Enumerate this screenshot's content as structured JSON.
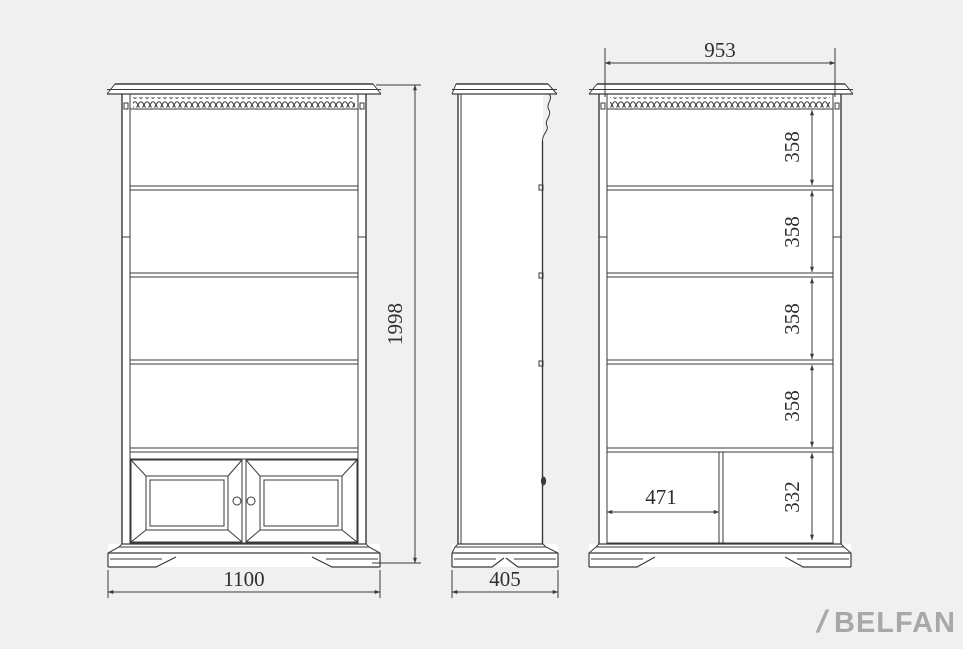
{
  "page": {
    "background": "#f0f0f0"
  },
  "drawing": {
    "line_color": "#3a3a3a",
    "face_color": "#ffffff",
    "front_view": {
      "overall_width_mm": "1100",
      "overall_height_mm": "1998"
    },
    "side_view": {
      "overall_depth_mm": "405"
    },
    "section_view": {
      "inner_width_mm": "953",
      "shelf_spacings_mm": [
        "358",
        "358",
        "358",
        "358"
      ],
      "bottom_compartment_height_mm": "332",
      "bottom_left_compartment_width_mm": "471"
    }
  },
  "logo": {
    "slash": "/",
    "brand": "BELFAN",
    "color": "#a8a8a8"
  }
}
